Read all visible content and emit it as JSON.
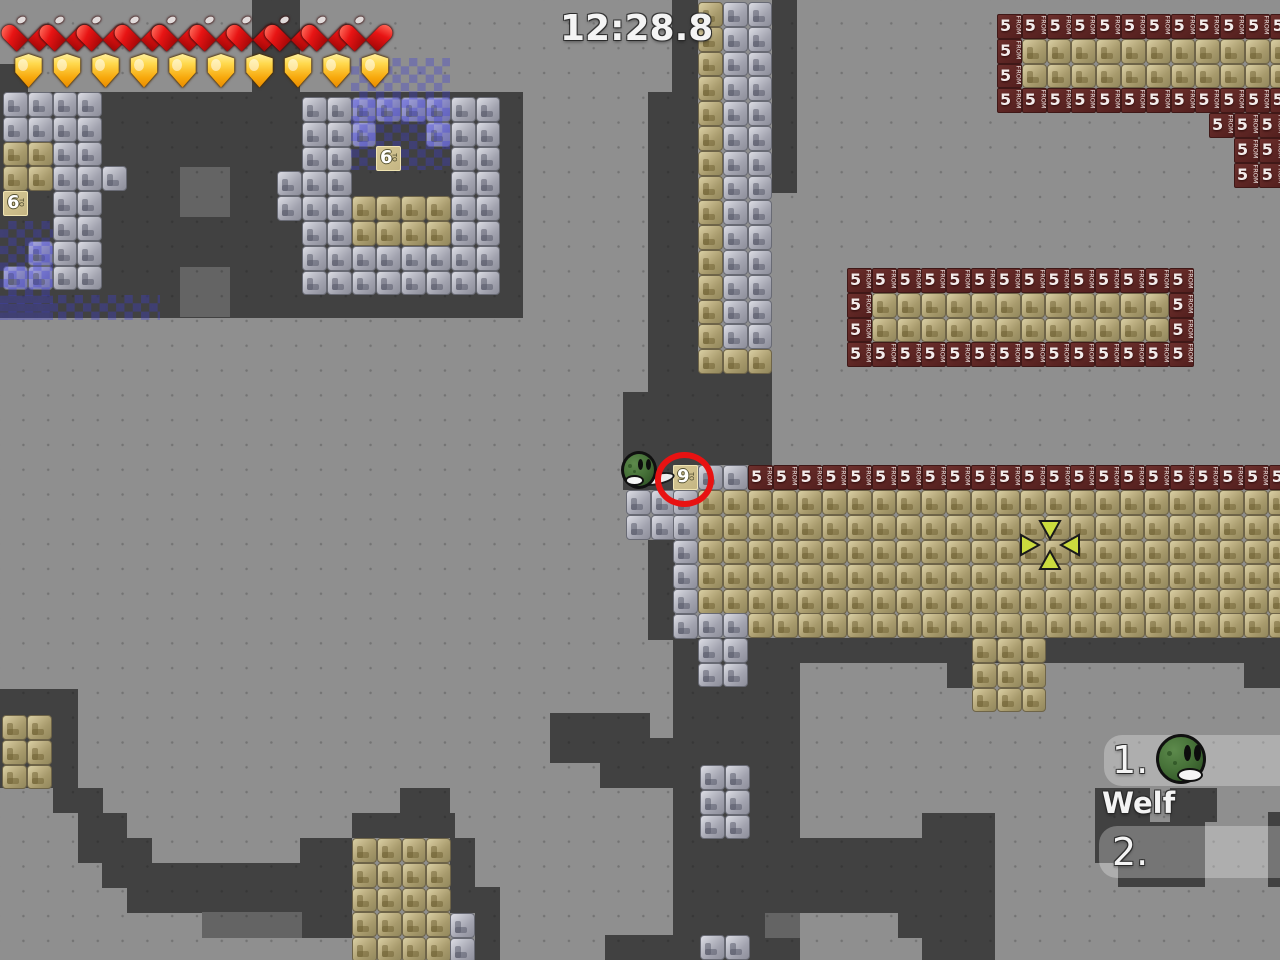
{
  "hud": {
    "timer": "12:28.8",
    "hearts": 10,
    "shields": 10
  },
  "leaderboard": {
    "entries": [
      {
        "rank": "1.",
        "name": "Welf",
        "has_avatar": true
      },
      {
        "rank": "2.",
        "name": "",
        "has_avatar": false
      }
    ]
  },
  "tiles": {
    "red_block": {
      "num": "5",
      "word": "FROM"
    },
    "labels": [
      {
        "x": 3,
        "y": 191,
        "num": "6",
        "word": "TO"
      },
      {
        "x": 376,
        "y": 146,
        "num": "6",
        "word": "TO"
      },
      {
        "x": 673,
        "y": 465,
        "num": "9",
        "word": "TO"
      }
    ]
  },
  "map": {
    "tile_size": 24.8,
    "colors": {
      "background": "#8f8f8f",
      "cave_dark": "#414141",
      "cave_medium": "#646464",
      "checker_blue": "rgba(60,60,215,0.33)",
      "red_block": "#5c2523",
      "tan_block": "#b0a476",
      "gray_block": "#9b9ca6",
      "annotation_red": "#e81212",
      "crosshair_yellow": "#ccdc3e"
    },
    "dark_rects": [
      [
        0,
        64,
        28,
        28
      ],
      [
        252,
        0,
        48,
        92
      ],
      [
        0,
        92,
        523,
        226
      ],
      [
        672,
        0,
        26,
        92
      ],
      [
        648,
        92,
        50,
        300
      ],
      [
        772,
        0,
        25,
        193
      ],
      [
        623,
        392,
        149,
        73
      ],
      [
        698,
        368,
        74,
        26
      ],
      [
        623,
        465,
        50,
        25
      ],
      [
        648,
        540,
        27,
        100
      ],
      [
        673,
        638,
        127,
        322
      ],
      [
        550,
        713,
        100,
        50
      ],
      [
        600,
        738,
        75,
        50
      ],
      [
        800,
        638,
        480,
        25
      ],
      [
        947,
        638,
        25,
        50
      ],
      [
        1244,
        663,
        36,
        25
      ],
      [
        0,
        689,
        78,
        99
      ],
      [
        53,
        763,
        25,
        50
      ],
      [
        78,
        788,
        25,
        75
      ],
      [
        102,
        813,
        25,
        75
      ],
      [
        127,
        838,
        25,
        75
      ],
      [
        152,
        863,
        25,
        50
      ],
      [
        177,
        863,
        125,
        50
      ],
      [
        300,
        838,
        52,
        100
      ],
      [
        352,
        813,
        103,
        25
      ],
      [
        400,
        788,
        50,
        25
      ],
      [
        450,
        838,
        25,
        75
      ],
      [
        475,
        887,
        25,
        73
      ],
      [
        605,
        935,
        68,
        25
      ],
      [
        800,
        838,
        122,
        75
      ],
      [
        898,
        913,
        24,
        25
      ],
      [
        922,
        813,
        73,
        147
      ],
      [
        1095,
        788,
        55,
        75
      ],
      [
        1170,
        788,
        47,
        34
      ],
      [
        1145,
        822,
        60,
        65
      ],
      [
        1118,
        862,
        75,
        25
      ],
      [
        1268,
        812,
        12,
        75
      ]
    ],
    "medium_rects": [
      [
        180,
        167,
        50,
        50
      ],
      [
        180,
        267,
        50,
        50
      ],
      [
        202,
        912,
        100,
        26
      ],
      [
        765,
        913,
        35,
        25
      ]
    ],
    "checker_rects": [
      [
        351,
        58,
        99,
        112
      ],
      [
        0,
        221,
        53,
        99
      ],
      [
        0,
        295,
        160,
        25
      ]
    ],
    "clusters": [
      {
        "x": 3,
        "y": 92,
        "rows": [
          "gggg",
          "gggg",
          "ttgg",
          "ttggg",
          "..gg",
          "..gg",
          ".bgg",
          "bbgg"
        ]
      },
      {
        "x": 302,
        "y": 97,
        "rows": [
          "ggbbbbgg",
          "ggb..bgg",
          "gg....gg",
          "gg....gg",
          "ggttttgg",
          "ggttttgg",
          "gggggggg",
          "gggggggg"
        ]
      },
      {
        "x": 277,
        "y": 171,
        "rows": [
          "g",
          "g"
        ]
      },
      {
        "x": 698,
        "y": 2,
        "rows": [
          "tgg",
          "tgg",
          "tgg",
          "tgg",
          "tgg",
          "tgg",
          "tgg",
          "tgg",
          "tgg",
          "tgg",
          "tgg",
          "tgg",
          "tgg",
          "tgg",
          "ttt"
        ]
      },
      {
        "x": 698,
        "y": 465,
        "rows": [
          "gg"
        ]
      },
      {
        "x": 748,
        "y": 465,
        "rows": [
          "rrrrrrrrrrrrrrrrrrrrrr"
        ]
      },
      {
        "x": 626,
        "y": 490,
        "rows": [
          "gg",
          "gg"
        ]
      },
      {
        "x": 673,
        "y": 490,
        "rows": [
          "g",
          "g",
          "g",
          "g",
          "g",
          "g"
        ]
      },
      {
        "x": 698,
        "y": 490,
        "rows": [
          "tttttttttttttttttttttttt",
          "tttttttttttttttttttttttt",
          "tttttttttttttttttttttttt",
          "tttttttttttttttttttttttt",
          "tttttttttttttttttttttttt"
        ]
      },
      {
        "x": 748,
        "y": 613,
        "rows": [
          "tttttttttttttttttttttt"
        ]
      },
      {
        "x": 698,
        "y": 613,
        "rows": [
          "gg",
          "gg",
          "gg"
        ]
      },
      {
        "x": 972,
        "y": 638,
        "rows": [
          "ttt",
          "ttt",
          "ttt"
        ]
      },
      {
        "x": 700,
        "y": 765,
        "rows": [
          "gg",
          "gg",
          "gg"
        ]
      },
      {
        "x": 700,
        "y": 935,
        "rows": [
          "gg"
        ]
      },
      {
        "x": 352,
        "y": 838,
        "rows": [
          "tttt",
          "tttt",
          "tttt",
          "tttt",
          "tttt"
        ]
      },
      {
        "x": 450,
        "y": 913,
        "rows": [
          "g",
          "g"
        ]
      },
      {
        "x": 2,
        "y": 715,
        "rows": [
          "tt",
          "tt",
          "tt"
        ]
      },
      {
        "x": 997,
        "y": 14,
        "rows": [
          "rrrrrrrrrrrr",
          "rttttttttttt",
          "rttttttttttt",
          "rrrrrrrrrrrr"
        ]
      },
      {
        "x": 1209,
        "y": 113,
        "rows": [
          "rrr"
        ]
      },
      {
        "x": 1234,
        "y": 138,
        "rows": [
          "rr",
          "rr"
        ]
      },
      {
        "x": 847,
        "y": 268,
        "rows": [
          "rrrrrrrrrrrrrr",
          "rttttttttttttr",
          "rttttttttttttr",
          "rrrrrrrrrrrrrr"
        ]
      }
    ],
    "crosshair": {
      "cx": 1050,
      "cy": 545
    },
    "annotation_circle": {
      "cx": 684,
      "cy": 480
    }
  },
  "character": {
    "x": 621,
    "y": 451
  }
}
